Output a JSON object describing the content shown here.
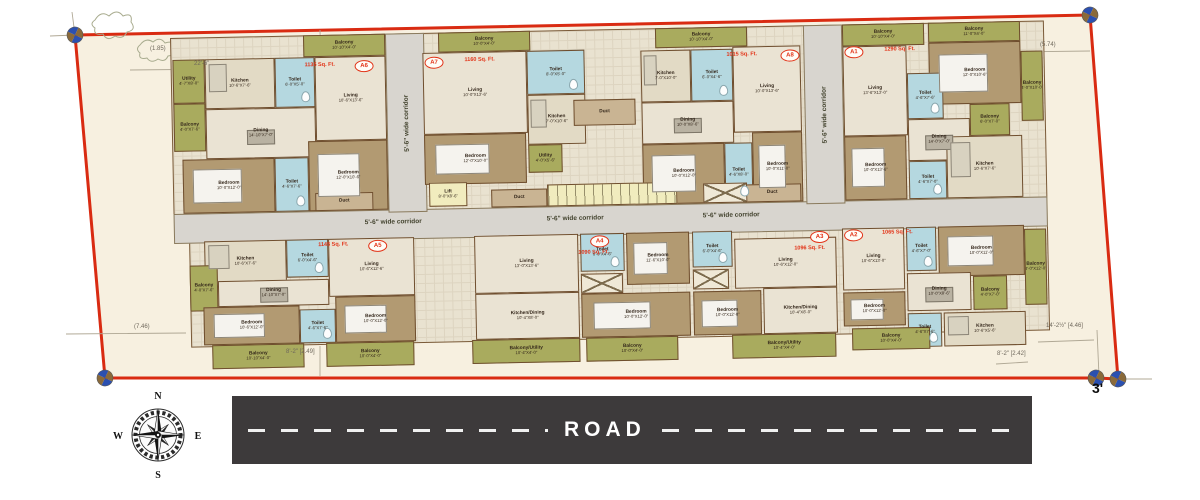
{
  "title": "apartment-site-floor-plan",
  "road": {
    "label": "ROAD"
  },
  "compass": {
    "north": "N",
    "south": "S",
    "east": "E",
    "west": "W"
  },
  "colors": {
    "boundary_red": "#d92b12",
    "plot_cream": "#f7f0e0",
    "road_dark": "#3d3a3b",
    "balcony_olive": "#a9ab5e",
    "toilet_blue": "#b5d8e0",
    "bedroom_tan": "#b29a72",
    "corridor_grey": "#d8d5cf",
    "lift_yellow": "#f1ecbe",
    "unit_label_red": "#e23317"
  },
  "site": {
    "corner_mark": "3'",
    "dims": [
      {
        "t": "(1.85)",
        "x": 150,
        "y": 46
      },
      {
        "t": "22'-6\"",
        "x": 194,
        "y": 61
      },
      {
        "t": "(5.74)",
        "x": 1040,
        "y": 42
      },
      {
        "t": "(7.46)",
        "x": 134,
        "y": 324
      },
      {
        "t": "14'-2½\" [4.46]",
        "x": 1046,
        "y": 323
      },
      {
        "t": "8'-2\" [2.42]",
        "x": 997,
        "y": 351
      },
      {
        "t": "8'-2\" [2.49]",
        "x": 286,
        "y": 349
      },
      {
        "t": "3'",
        "x": 1092,
        "y": 380,
        "big": true
      }
    ]
  },
  "building": {
    "corridor_label": "5'-6\" wide corridor",
    "services": [
      [
        "duct",
        "Duct",
        "",
        402,
        70,
        62,
        26
      ],
      [
        "duct",
        "Duct",
        "",
        142,
        158,
        58,
        18
      ],
      [
        "duct",
        "Duct",
        "",
        318,
        158,
        56,
        18
      ],
      [
        "duct",
        "Duct",
        "",
        570,
        158,
        58,
        18
      ],
      [
        "service",
        "Lift",
        "8'-0\"X8'-6\"",
        256,
        150,
        38,
        24
      ],
      [
        "stair",
        "",
        "",
        374,
        154,
        130,
        22
      ],
      [
        "shaft",
        "",
        "",
        530,
        156,
        44,
        20
      ]
    ],
    "units": [
      {
        "id": "A6",
        "area": "1135 Sq. Ft.",
        "lx": 184,
        "ly": 26,
        "ax": 134,
        "ay": 27,
        "rooms": [
          [
            "balcony",
            "Balcony",
            "10'-10\"X4'-0\"",
            133,
            0,
            82,
            22
          ],
          [
            "balcony",
            "Utility",
            "4'-7\"X8'-0\"",
            2,
            22,
            32,
            44
          ],
          [
            "kitchen",
            "Kitchen",
            "10'-6\"X7'-6\"",
            34,
            22,
            70,
            50
          ],
          [
            "toilet",
            "Toilet",
            "6'-0\"X5'-0\"",
            104,
            22,
            40,
            50
          ],
          [
            "floor",
            "Living",
            "10'-6\"X13'-6\"",
            144,
            22,
            71,
            84
          ],
          [
            "balcony",
            "Balcony",
            "4'-0\"X7'-6\"",
            2,
            66,
            32,
            48
          ],
          [
            "dining",
            "Dining",
            "14'-10\"X7'-0\"",
            34,
            72,
            110,
            50
          ],
          [
            "bed",
            "Bedroom",
            "10'-0\"X12'-0\"",
            10,
            122,
            92,
            54
          ],
          [
            "toilet",
            "Toilet",
            "4'-6\"X7'-6\"",
            102,
            122,
            34,
            54
          ],
          [
            "bed",
            "Bedroom",
            "12'-0\"X10'-6\"",
            136,
            106,
            79,
            70
          ]
        ]
      },
      {
        "id": "A7",
        "area": "1160 Sq. Ft.",
        "lx": 254,
        "ly": 24,
        "ax": 294,
        "ay": 25,
        "rooms": [
          [
            "balcony",
            "Balcony",
            "10'-0\"X4'-0\"",
            268,
            0,
            92,
            20
          ],
          [
            "floor",
            "Living",
            "10'-0\"X13'-6\"",
            252,
            20,
            104,
            82
          ],
          [
            "toilet",
            "Toilet",
            "8'-0\"X5'-0\"",
            356,
            20,
            58,
            44
          ],
          [
            "kitchen",
            "Kitchen",
            "7'-0\"X10'-6\"",
            356,
            64,
            58,
            50
          ],
          [
            "bed",
            "Bedroom",
            "12'-0\"X10'-0\"",
            252,
            102,
            102,
            50
          ],
          [
            "balcony",
            "Utility",
            "4'-0\"X5'-6\"",
            356,
            114,
            34,
            28
          ]
        ]
      },
      {
        "id": "A8",
        "area": "1015 Sq. Ft.",
        "lx": 610,
        "ly": 24,
        "ax": 556,
        "ay": 25,
        "rooms": [
          [
            "balcony",
            "Balcony",
            "10'-10\"X4'-0\"",
            485,
            0,
            92,
            20
          ],
          [
            "kitchen",
            "Kitchen",
            "7'-0\"X10'-0\"",
            470,
            22,
            50,
            52
          ],
          [
            "toilet",
            "Toilet",
            "6'-0\"X4'-6\"",
            520,
            22,
            42,
            52
          ],
          [
            "floor",
            "Living",
            "10'-0\"X13'-6\"",
            562,
            20,
            68,
            86
          ],
          [
            "dining",
            "Dining",
            "10'-0\"X8'-6\"",
            470,
            74,
            92,
            42
          ],
          [
            "bed",
            "Bedroom",
            "10'-0\"X12'-0\"",
            470,
            116,
            82,
            60
          ],
          [
            "toilet",
            "Toilet",
            "4'-6\"X8'-0\"",
            552,
            116,
            28,
            60
          ],
          [
            "bed",
            "Bedroom",
            "10'-0\"X11'-0\"",
            580,
            106,
            50,
            70
          ]
        ]
      },
      {
        "id": "A1",
        "area": "1290 Sq. Ft.",
        "lx": 674,
        "ly": 22,
        "ax": 714,
        "ay": 23,
        "rooms": [
          [
            "balcony",
            "Balcony",
            "10'-10\"X4'-0\"",
            672,
            0,
            82,
            22
          ],
          [
            "balcony",
            "Balcony",
            "11'-0\"X4'-0\"",
            758,
            0,
            92,
            20
          ],
          [
            "floor",
            "Living",
            "13'-6\"X13'-0\"",
            672,
            22,
            64,
            90
          ],
          [
            "bed",
            "Bedroom",
            "12'-0\"X10'-6\"",
            758,
            20,
            92,
            62
          ],
          [
            "toilet",
            "Toilet",
            "4'-6\"X7'-6\"",
            736,
            50,
            36,
            46
          ],
          [
            "dining",
            "Dining",
            "14'-0\"X7'-0\"",
            736,
            96,
            62,
            42
          ],
          [
            "balcony",
            "Balcony",
            "6'-0\"X7'-0\"",
            798,
            82,
            40,
            32
          ],
          [
            "bed",
            "Bedroom",
            "10'-0\"X13'-6\"",
            672,
            112,
            62,
            64
          ],
          [
            "toilet",
            "Toilet",
            "4'-6\"X7'-0\"",
            736,
            138,
            38,
            38
          ],
          [
            "kitchen",
            "Kitchen",
            "10'-6\"X7'-6\"",
            774,
            114,
            76,
            62
          ],
          [
            "balcony",
            "Balcony",
            "4'-0\"X10'-0\"",
            850,
            30,
            22,
            70
          ]
        ]
      },
      {
        "id": "A5",
        "area": "1145 Sq. Ft.",
        "lx": 194,
        "ly": 206,
        "ax": 144,
        "ay": 207,
        "rooms": [
          [
            "kitchen",
            "Kitchen",
            "10'-6\"X7'-6\"",
            30,
            204,
            82,
            42
          ],
          [
            "toilet",
            "Toilet",
            "6'-0\"X4'-6\"",
            112,
            204,
            42,
            38
          ],
          [
            "floor",
            "Living",
            "10'-6\"X12'-6\"",
            154,
            204,
            86,
            58
          ],
          [
            "balcony",
            "Balcony",
            "4'-0\"X7'-6\"",
            15,
            228,
            28,
            46
          ],
          [
            "dining",
            "Dining",
            "14'-10\"X7'-0\"",
            43,
            244,
            111,
            26
          ],
          [
            "bed",
            "Bedroom",
            "10'-6\"X12'-0\"",
            28,
            270,
            96,
            38
          ],
          [
            "toilet",
            "Toilet",
            "4'-6\"X7'-6\"",
            124,
            274,
            36,
            34
          ],
          [
            "bed",
            "Bedroom",
            "10'-0\"X12'-0\"",
            160,
            262,
            80,
            46
          ],
          [
            "balcony",
            "Balcony",
            "10'-10\"X4'-0\"",
            36,
            308,
            92,
            24
          ],
          [
            "balcony",
            "Balcony",
            "10'-0\"X4'-0\"",
            150,
            308,
            88,
            24
          ]
        ]
      },
      {
        "id": "A4",
        "area": "1090 Sq. Ft.",
        "lx": 416,
        "ly": 206,
        "ax": 404,
        "ay": 220,
        "rooms": [
          [
            "floor",
            "Living",
            "13'-0\"X13'-6\"",
            300,
            204,
            104,
            58
          ],
          [
            "toilet",
            "Toilet",
            "6'-0\"X4'-6\"",
            406,
            204,
            44,
            38
          ],
          [
            "bed",
            "Bedroom",
            "11'-6\"X10'-0\"",
            452,
            204,
            63,
            52
          ],
          [
            "shaft",
            "",
            "",
            406,
            244,
            42,
            20
          ],
          [
            "floor",
            "Kitchen/Dining",
            "10'-4\"X8'-0\"",
            300,
            262,
            104,
            46
          ],
          [
            "bed",
            "Bedroom",
            "10'-0\"X12'-0\"",
            406,
            264,
            109,
            44
          ],
          [
            "balcony",
            "Balcony/Utility",
            "10'-4\"X4'-0\"",
            296,
            308,
            108,
            24
          ],
          [
            "balcony",
            "Balcony",
            "10'-0\"X4'-0\"",
            410,
            308,
            92,
            24
          ]
        ]
      },
      {
        "id": "A3",
        "area": "1096 Sq. Ft.",
        "lx": 636,
        "ly": 206,
        "ax": 620,
        "ay": 220,
        "rooms": [
          [
            "toilet",
            "Toilet",
            "6'-0\"X4'-6\"",
            518,
            204,
            40,
            36
          ],
          [
            "shaft",
            "",
            "",
            518,
            242,
            36,
            20
          ],
          [
            "floor",
            "Living",
            "10'-6\"X12'-0\"",
            560,
            212,
            102,
            50
          ],
          [
            "bed",
            "Bedroom",
            "10'-0\"X12'-0\"",
            518,
            264,
            68,
            44
          ],
          [
            "floor",
            "Kitchen/Dining",
            "10'-4\"X8'-0\"",
            588,
            262,
            74,
            46
          ],
          [
            "balcony",
            "Balcony/Utility",
            "10'-4\"X4'-0\"",
            556,
            308,
            104,
            24
          ]
        ]
      },
      {
        "id": "A2",
        "area": "1065 Sq. Ft.",
        "lx": 670,
        "ly": 205,
        "ax": 708,
        "ay": 206,
        "rooms": [
          [
            "floor",
            "Living",
            "10'-6\"X13'-0\"",
            668,
            204,
            62,
            62
          ],
          [
            "toilet",
            "Toilet",
            "4'-6\"X7'-0\"",
            732,
            204,
            30,
            44
          ],
          [
            "bed",
            "Bedroom",
            "10'-0\"X11'-0\"",
            764,
            204,
            86,
            50
          ],
          [
            "dining",
            "Dining",
            "10'-0\"X8'-6\"",
            732,
            250,
            64,
            38
          ],
          [
            "balcony",
            "Balcony",
            "4'-0\"X7'-0\"",
            798,
            254,
            34,
            34
          ],
          [
            "bed",
            "Bedroom",
            "10'-0\"X12'-0\"",
            668,
            268,
            62,
            34
          ],
          [
            "toilet",
            "Toilet",
            "4'-6\"X7'-6\"",
            732,
            290,
            34,
            34
          ],
          [
            "kitchen",
            "Kitchen",
            "10'-6\"X5'-6\"",
            768,
            290,
            82,
            34
          ],
          [
            "balcony",
            "Balcony",
            "10'-0\"X4'-0\"",
            676,
            304,
            78,
            22
          ],
          [
            "balcony",
            "Balcony",
            "4'-0\"X12'-0\"",
            850,
            208,
            22,
            76
          ]
        ]
      }
    ]
  }
}
